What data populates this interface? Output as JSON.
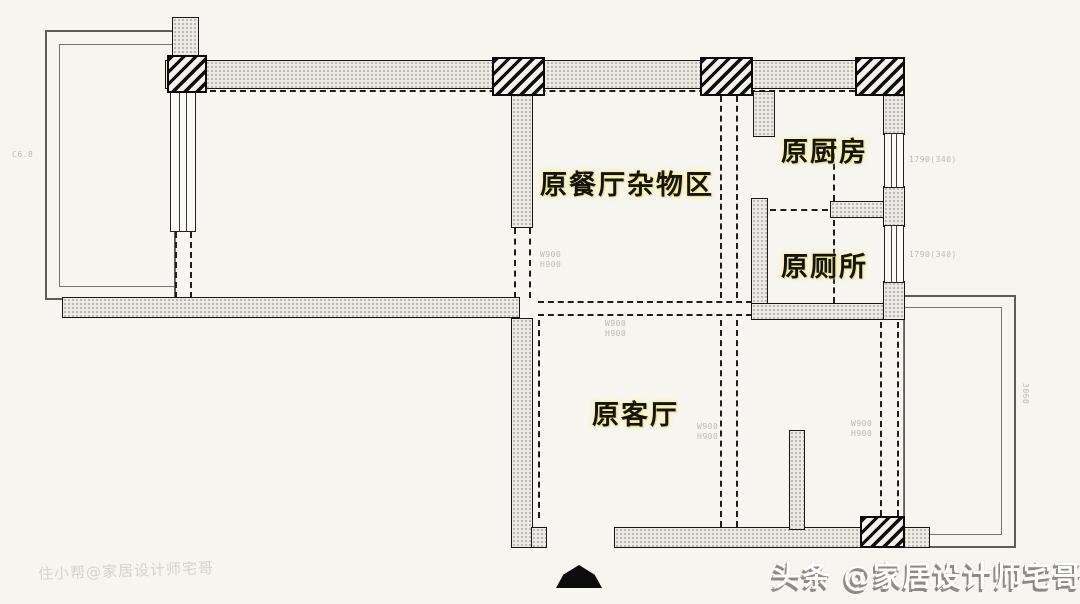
{
  "canvas": {
    "width": 1080,
    "height": 604,
    "background": "#f6f5f0"
  },
  "rooms": {
    "dining": {
      "label": "原餐厅杂物区"
    },
    "kitchen": {
      "label": "原厨房"
    },
    "toilet": {
      "label": "原厕所"
    },
    "living": {
      "label": "原客厅"
    }
  },
  "annotations": {
    "mid_wall_opening": "W900\nH900",
    "hall_opening": "W900\nH900",
    "living_opening": "W900\nH900",
    "living_right_opening": "W900\nH900",
    "kitchen_window": "1790(340)",
    "toilet_window": "1790(340)",
    "right_balcony_dim": "3060",
    "left_edge_dim": "C6.8"
  },
  "watermarks": {
    "bottom_left": "住小帮@家居设计师宅哥",
    "bottom_right": "头条 @家居设计师宅哥"
  },
  "symbols": {
    "entry_arrow": "entry-direction"
  },
  "colors": {
    "background": "#f6f5f0",
    "wall_fill": "#eceae4",
    "wall_dot": "#a9a8a2",
    "outline": "#161616",
    "pillar_hatch": "#0f0f0f",
    "thin_line": "#5d5c58",
    "label_text": "#141414",
    "label_glow": "#fcee78",
    "watermark_right_fill": "#fdfdfb",
    "watermark_right_shadow": "#8d8b86",
    "watermark_left": "rgba(186,183,172,0.55)"
  }
}
